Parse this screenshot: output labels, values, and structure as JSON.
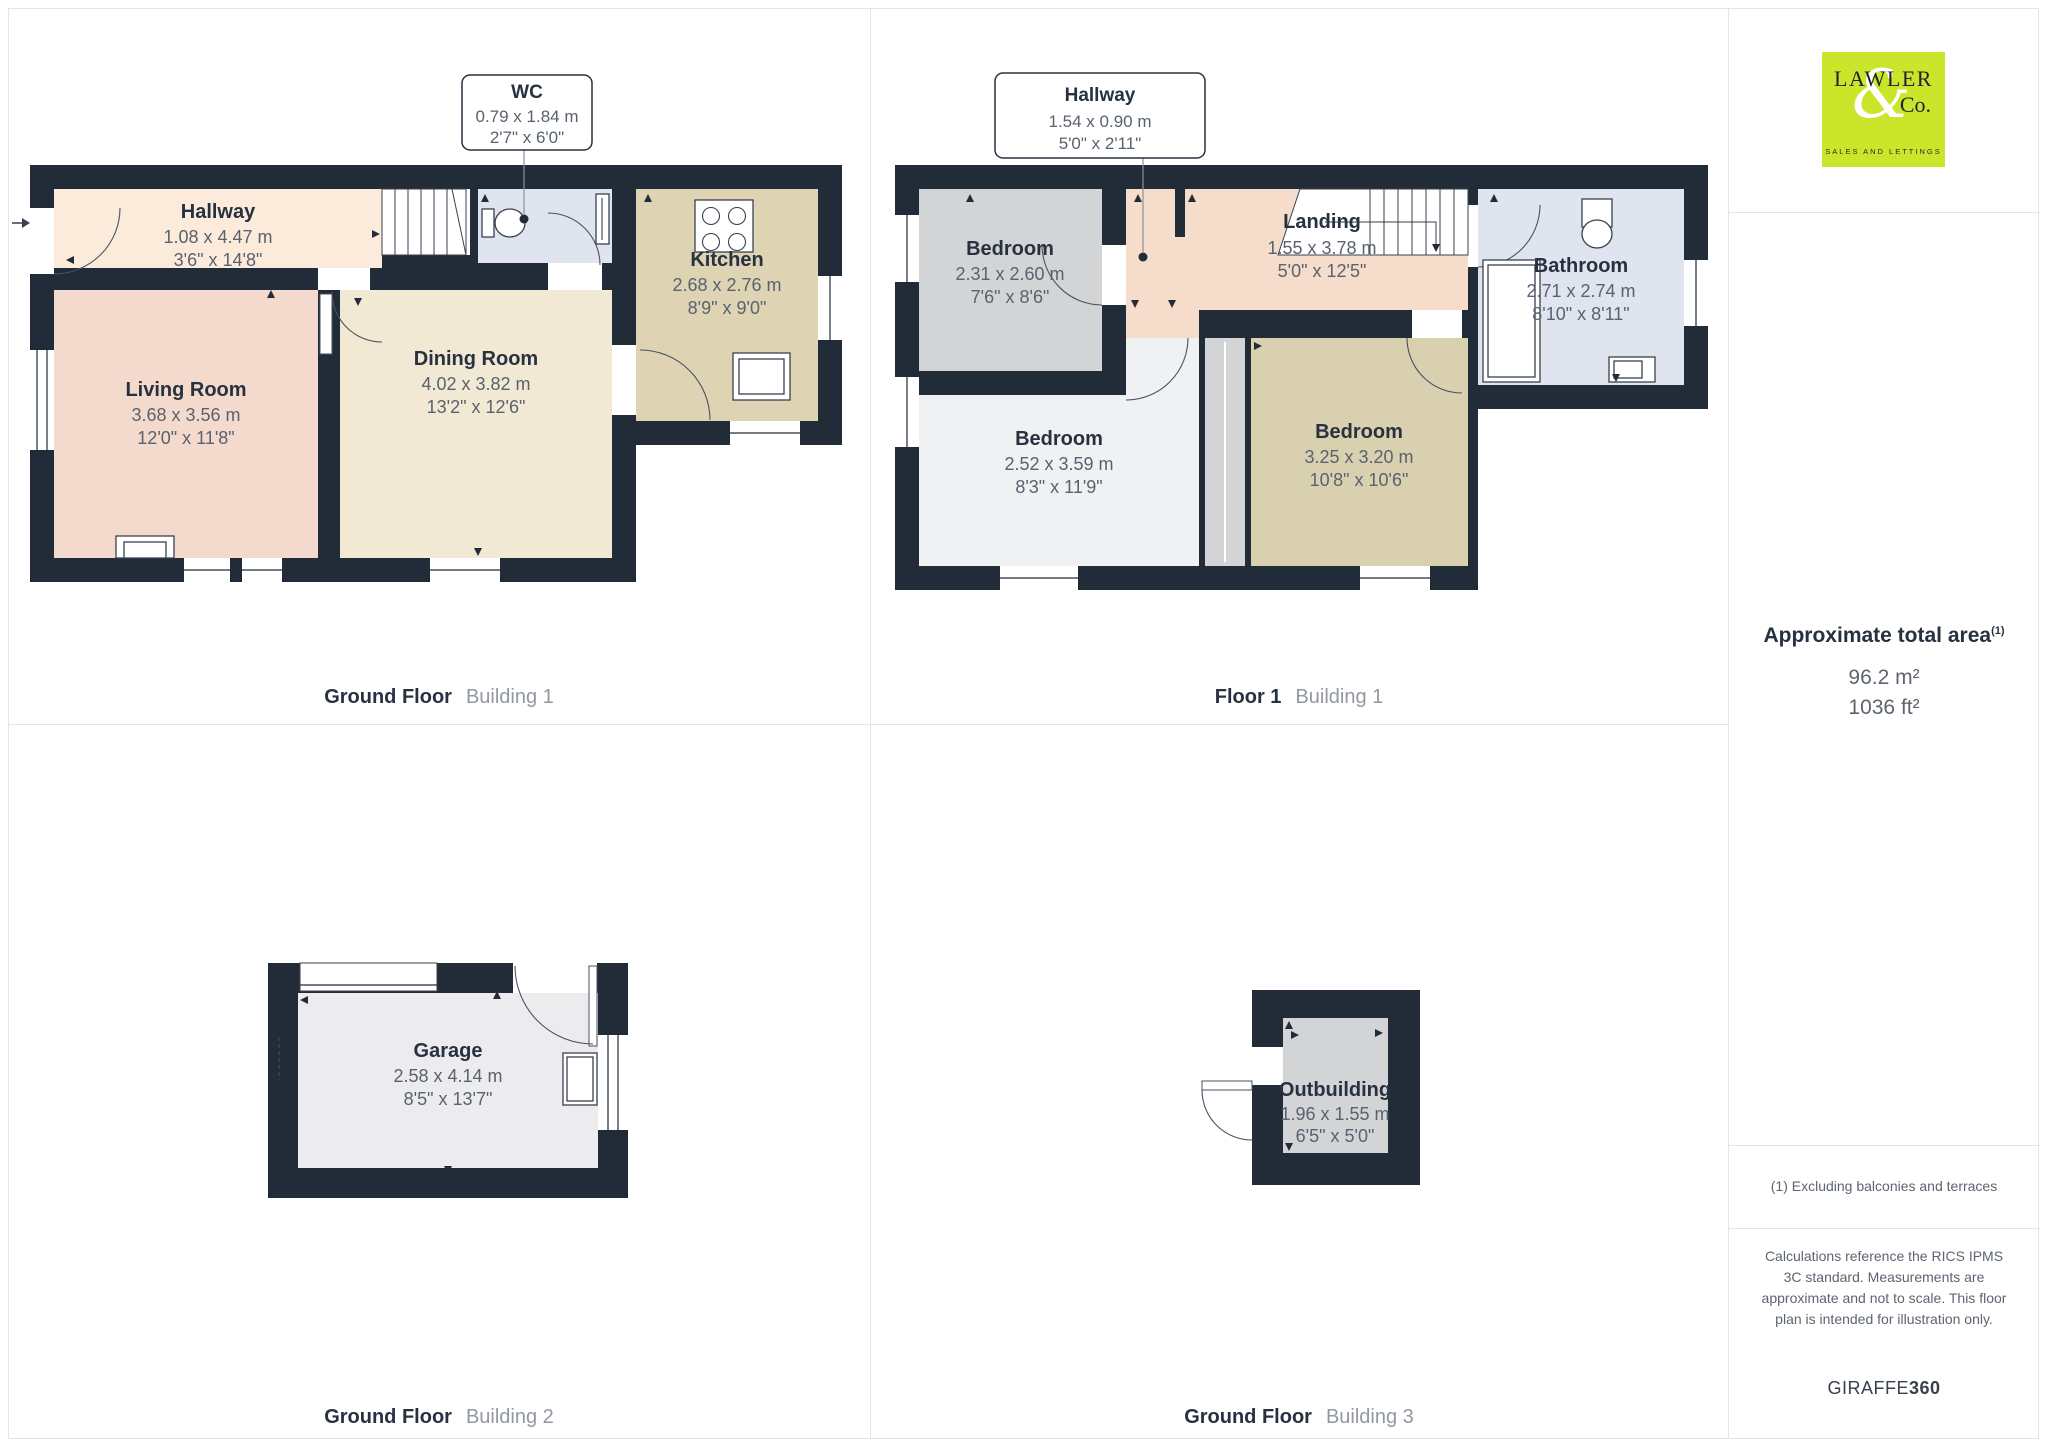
{
  "branding": {
    "logo_line1": "LAWLER",
    "logo_ampersand": "&",
    "logo_line2": "Co.",
    "logo_tagline": "SALES AND LETTINGS",
    "logo_bg_color": "#cbe52b"
  },
  "sidebar": {
    "total_area_label": "Approximate total area",
    "total_area_footnote_marker": "(1)",
    "total_area_m2": "96.2 m²",
    "total_area_ft2": "1036 ft²",
    "footnote": "(1) Excluding balconies and terraces",
    "disclaimer": "Calculations reference the RICS IPMS 3C standard. Measurements are approximate and not to scale. This floor plan is intended for illustration only.",
    "brand_regular": "GIRAFFE",
    "brand_bold": "360"
  },
  "panels": [
    {
      "caption_floor": "Ground Floor",
      "caption_building": "Building 1"
    },
    {
      "caption_floor": "Floor 1",
      "caption_building": "Building 1"
    },
    {
      "caption_floor": "Ground Floor",
      "caption_building": "Building 2"
    },
    {
      "caption_floor": "Ground Floor",
      "caption_building": "Building 3"
    }
  ],
  "rooms": {
    "hallway_gf": {
      "name": "Hallway",
      "metric": "1.08 x 4.47 m",
      "imperial": "3'6\" x 14'8\""
    },
    "living": {
      "name": "Living Room",
      "metric": "3.68 x 3.56 m",
      "imperial": "12'0\" x 11'8\""
    },
    "dining": {
      "name": "Dining Room",
      "metric": "4.02 x 3.82 m",
      "imperial": "13'2\" x 12'6\""
    },
    "wc": {
      "name": "WC",
      "metric": "0.79 x 1.84 m",
      "imperial": "2'7\" x 6'0\""
    },
    "kitchen": {
      "name": "Kitchen",
      "metric": "2.68 x 2.76 m",
      "imperial": "8'9\" x 9'0\""
    },
    "hallway_f1": {
      "name": "Hallway",
      "metric": "1.54 x 0.90 m",
      "imperial": "5'0\" x 2'11\""
    },
    "bedroom_small": {
      "name": "Bedroom",
      "metric": "2.31 x 2.60 m",
      "imperial": "7'6\" x 8'6\""
    },
    "landing": {
      "name": "Landing",
      "metric": "1.55 x 3.78 m",
      "imperial": "5'0\" x 12'5\""
    },
    "bedroom_left": {
      "name": "Bedroom",
      "metric": "2.52 x 3.59 m",
      "imperial": "8'3\" x 11'9\""
    },
    "bedroom_right": {
      "name": "Bedroom",
      "metric": "3.25 x 3.20 m",
      "imperial": "10'8\" x 10'6\""
    },
    "bathroom": {
      "name": "Bathroom",
      "metric": "2.71 x 2.74 m",
      "imperial": "8'10\" x 8'11\""
    },
    "garage": {
      "name": "Garage",
      "metric": "2.58 x 4.14 m",
      "imperial": "8'5\" x 13'7\""
    },
    "outbuilding": {
      "name": "Outbuilding",
      "metric": "1.96 x 1.55 m",
      "imperial": "6'5\" x 5'0\""
    }
  },
  "colors": {
    "wall": "#222c39",
    "hallway_gf": "#fcebdb",
    "living": "#f4dacc",
    "dining": "#f2e9d4",
    "kitchen": "#ded3b3",
    "wc_bathroom": "#dfe4ef",
    "bedroom_gray": "#d3d4d6",
    "bedroom_light": "#f0f1f3",
    "bedroom_tan": "#d9d0b0",
    "hallway_f1": "#f6dcca",
    "garage": "#ececee",
    "outbuilding": "#d3d4d6",
    "logo_accent": "#cbe52b",
    "label_dark": "#273140",
    "label_gray": "#59626f"
  }
}
